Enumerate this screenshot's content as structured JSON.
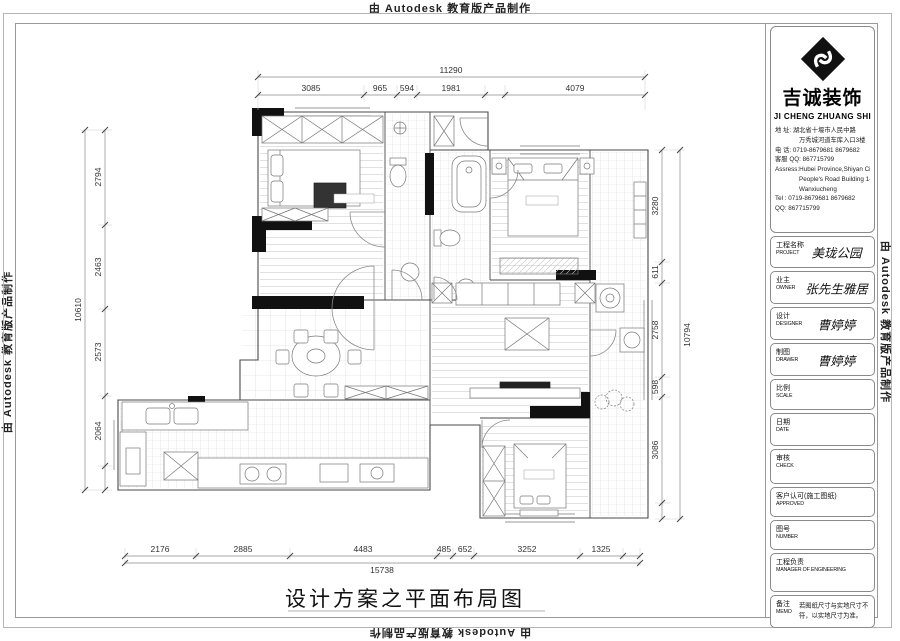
{
  "watermarks": {
    "text": "由 Autodesk 教育版产品制作"
  },
  "title_block": {
    "company": {
      "name_cn": "吉诚装饰",
      "name_en": "JI CHENG ZHUANG SHI",
      "address_lines": [
        "地    址: 湖北省十堰市人民中路",
        "万秀城河道车库入口3楼",
        "电    话: 0719-8679681  8679682",
        "客服 QQ: 867715799",
        "Assress:Hubei Province,Shiyan City",
        "People's Road Building 1-21",
        "Wanxiucheng",
        "Tel : 0719-8679681  8679682",
        "QQ: 867715799"
      ]
    },
    "rows": [
      {
        "label_cn": "工程名称",
        "label_en": "PROJECT",
        "value": "美珑公园"
      },
      {
        "label_cn": "业主",
        "label_en": "OWNER",
        "value": "张先生雅居"
      },
      {
        "label_cn": "设计",
        "label_en": "DESIGNER",
        "value": "曹婷婷"
      },
      {
        "label_cn": "制图",
        "label_en": "DRAWER",
        "value": "曹婷婷"
      },
      {
        "label_cn": "比例",
        "label_en": "SCALE",
        "value": ""
      },
      {
        "label_cn": "日期",
        "label_en": "DATE",
        "value": ""
      },
      {
        "label_cn": "审核",
        "label_en": "CHECK",
        "value": ""
      },
      {
        "label_cn": "客户认可(施工图纸)",
        "label_en": "APPROVED",
        "value": ""
      },
      {
        "label_cn": "图号",
        "label_en": "NUMBER",
        "value": ""
      },
      {
        "label_cn": "工程负责",
        "label_en": "MANAGER OF ENGINEERING",
        "value": ""
      },
      {
        "label_cn": "备注",
        "label_en": "MEMO",
        "value": "若图纸尺寸与实地尺寸不符，以实地尺寸为准。"
      }
    ]
  },
  "drawing": {
    "title": "设计方案之平面布局图",
    "dimensions": {
      "top": {
        "overall": "11290",
        "segments": [
          "3085",
          "965",
          "594",
          "1981",
          "4079"
        ]
      },
      "left": {
        "overall": "10610",
        "segments": [
          "2794",
          "2463",
          "2573",
          "2064"
        ]
      },
      "right": {
        "overall": "10794",
        "segments": [
          "3280",
          "611",
          "2758",
          "598",
          "3086"
        ]
      },
      "bottom": {
        "overall": "15738",
        "segments": [
          "2176",
          "2885",
          "4483",
          "485",
          "652",
          "3252",
          "1325"
        ]
      }
    }
  }
}
